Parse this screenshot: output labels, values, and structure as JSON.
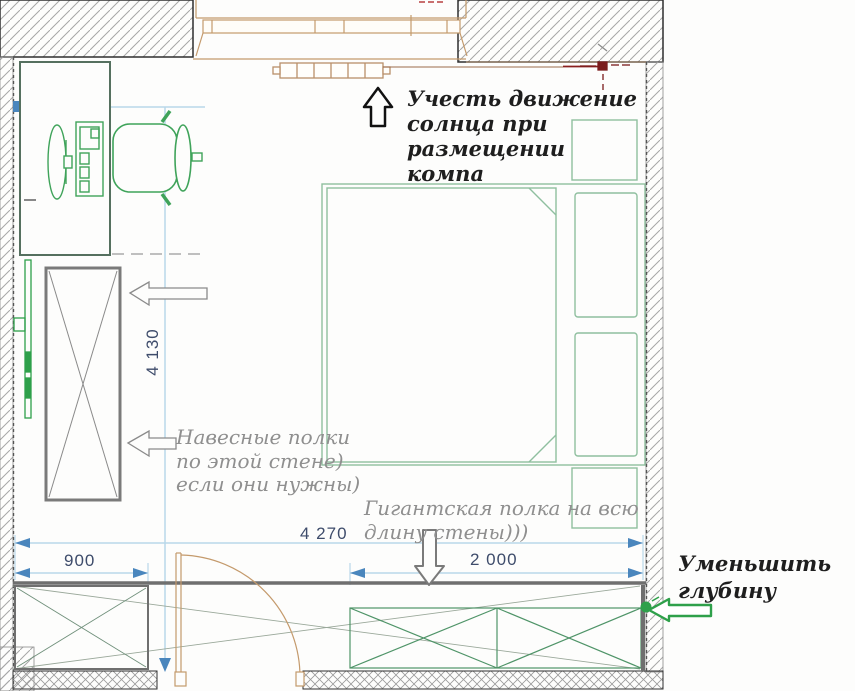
{
  "plan": {
    "title": "bedroom-floor-plan",
    "dimensions": {
      "total_width": "4 270",
      "left_segment": "900",
      "right_segment": "2 000",
      "room_height": "4 130"
    },
    "annotations": {
      "sun_note": {
        "lines": [
          "Учесть движение",
          "солнца при",
          "размещении",
          "компа"
        ]
      },
      "shelves_note": {
        "lines": [
          "Навесные полки",
          "по этой стене)",
          "если они нужны)"
        ]
      },
      "giant_shelf_note": {
        "lines": [
          "Гигантская полка на всю",
          "длину стены)))"
        ]
      },
      "reduce_depth_note": {
        "lines": [
          "Уменьшить",
          "глубину"
        ]
      }
    },
    "icons": [
      "bed",
      "pillow",
      "nightstand",
      "desk",
      "monitor",
      "keyboard",
      "office-chair",
      "wall-tv",
      "wardrobe",
      "door",
      "window",
      "radiator",
      "power-outlet",
      "up-arrow",
      "left-arrow",
      "down-arrow",
      "green-left-arrow",
      "shelf"
    ],
    "colors": {
      "dimension_blue": "#4a86bd",
      "dimension_text": "#3e4c6b",
      "guide_blue": "#b9d8ea",
      "furniture_green": "#3fa35a",
      "bed_green": "#8fbf9f",
      "shelf_green": "#4f9468",
      "wood_tan": "#c49a6c",
      "wall_hatch_gray": "#a6a6a6",
      "annotation_gray": "#8f8f8f",
      "annotation_black": "#1e1e1e",
      "accent_red": "#8a1f1f",
      "arrow_green": "#2ea04a"
    }
  }
}
